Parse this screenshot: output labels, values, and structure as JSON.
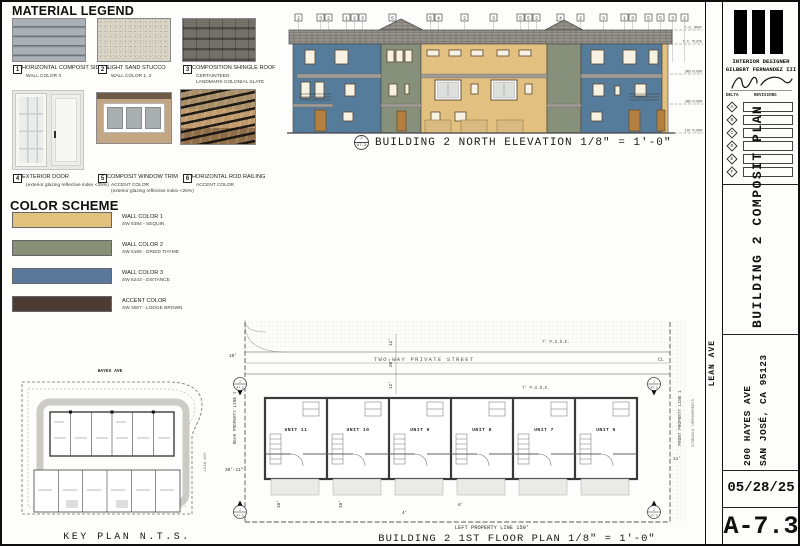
{
  "legend": {
    "title": "MATERIAL LEGEND",
    "items": [
      {
        "num": "1",
        "label": "HORIZONTAL COMPOSIT SIDING",
        "sub1": "WALL COLOR 3",
        "sub2": ""
      },
      {
        "num": "2",
        "label": "LIGHT SAND STUCCO",
        "sub1": "WALL COLOR 1, 2",
        "sub2": ""
      },
      {
        "num": "3",
        "label": "COMPOSITION SHINGLE ROOF",
        "sub1": "CERTAINTEED",
        "sub2": "LANDMARK COLONIAL SLATE"
      },
      {
        "num": "4",
        "label": "EXTERIOR DOOR",
        "sub1": "(exterior glazing reflective index <25%)",
        "sub2": ""
      },
      {
        "num": "5",
        "label": "COMPOSIT WINDOW TRIM",
        "sub1": "ACCENT COLOR",
        "sub2": "(exterior glazing reflective index <25%)"
      },
      {
        "num": "6",
        "label": "HORIZONTAL ROD RAILING",
        "sub1": "ACCENT COLOR",
        "sub2": ""
      }
    ]
  },
  "colors": {
    "title": "COLOR SCHEME",
    "swatches": [
      {
        "label": "WALL COLOR 1",
        "code": "SW 6394 - SEQUIN",
        "hex": "#e2c17f"
      },
      {
        "label": "WALL COLOR 2",
        "code": "SW 6186 - DRIED THYME",
        "hex": "#8a9077"
      },
      {
        "label": "WALL COLOR 3",
        "code": "SW 6243 - DISTANCE",
        "hex": "#59789a"
      },
      {
        "label": "ACCENT COLOR",
        "code": "SW 3007 - LODGE BROWN",
        "hex": "#4c3c33"
      }
    ]
  },
  "elevation": {
    "marker_num": "2",
    "marker_sheet": "A7.3",
    "title": "BUILDING 2 NORTH ELEVATION 1/8\" = 1'-0\"",
    "callouts": [
      "2",
      "3",
      "2",
      "1",
      "2",
      "3",
      "5",
      "5",
      "4",
      "2",
      "3",
      "5",
      "5",
      "2",
      "4",
      "2",
      "3",
      "1",
      "3",
      "5",
      "5",
      "3",
      "2"
    ],
    "levels": [
      "T.O. ROOF",
      "T.O. PLATE",
      "3RD FLOOR",
      "2ND FLOOR",
      "1ST FLOOR"
    ]
  },
  "floorplan": {
    "title": "BUILDING 2 1ST FLOOR PLAN 1/8\" = 1'-0\"",
    "street": "TWO-WAY PRIVATE STREET",
    "pude_top": "7' P.U.D.E.",
    "pude_bot": "7' P.U.D.E.",
    "centerline": "CL",
    "units": [
      "UNIT 11",
      "UNIT 10",
      "UNIT 9",
      "UNIT 8",
      "UNIT 7",
      "UNIT 6"
    ],
    "rear_property": "REAR PROPERTY LINE 1",
    "front_property": "FRONT PROPERTY LINE 1",
    "left_property": "LEFT PROPERTY LINE 150'",
    "sidewalk": "SIDEWALK IMPROVEMENTS",
    "marker_num": "2",
    "marker_sheet": "A7.3",
    "dims": {
      "pude_n": "12'",
      "street_width": "20'",
      "pude_s": "12'",
      "rear_setback": "10'",
      "depth": "30'-11\"",
      "side_a": "10'",
      "side_b": "10'",
      "front_dim": "11'",
      "porch": "4'",
      "stair": "6'"
    }
  },
  "keyplan": {
    "street_top": "HAYES AVE",
    "street_right": "LEAN AVE",
    "title": "KEY PLAN N.T.S."
  },
  "street_right": "LEAN AVE",
  "titleblock": {
    "firm_line1": "INTERIOR DESIGNER",
    "firm_line2": "GILBERT FERNANDEZ III",
    "delta": "DELTA",
    "revisions": "REVISIONS",
    "rev_rows": [
      {
        "id": "A",
        "note": "-"
      },
      {
        "id": "B",
        "note": "-"
      },
      {
        "id": "C",
        "note": "-"
      },
      {
        "id": "D",
        "note": "-"
      },
      {
        "id": "E",
        "note": "-"
      },
      {
        "id": "F",
        "note": "-"
      }
    ],
    "sheet_title": "BUILDING 2 COMPOSIT PLAN",
    "address1": "200 HAYES AVE",
    "address2": "SAN JOSÉ, CA 95123",
    "date": "05/28/25",
    "sheet_no": "A-7.3"
  }
}
